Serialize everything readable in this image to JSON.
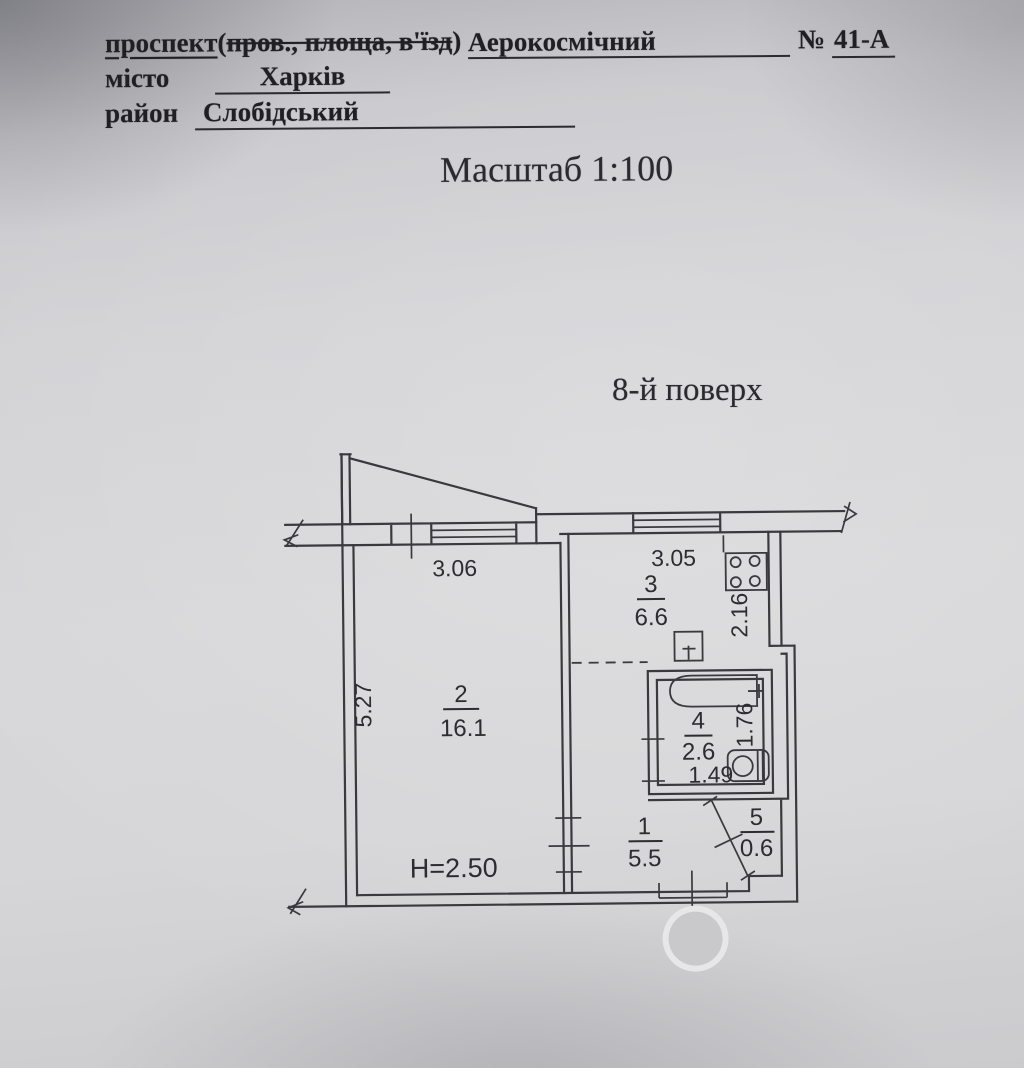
{
  "document": {
    "street": {
      "label_underlined": "проспект",
      "label_paren_open": "(",
      "label_struck": "пров., площа, в'їзд",
      "label_paren_close": ")",
      "value": "Аерокосмічний",
      "number_sign": "№",
      "number_value": "41-А"
    },
    "city": {
      "label": "місто",
      "value": "Харків"
    },
    "district": {
      "label": "район",
      "value": "Слобідський"
    },
    "scale_text": "Масштаб 1:100",
    "floor_text": "8-й поверх"
  },
  "plan": {
    "ceiling_height": "H=2.50",
    "rooms": [
      {
        "number": "1",
        "area": "5.5"
      },
      {
        "number": "2",
        "area": "16.1"
      },
      {
        "number": "3",
        "area": "6.6"
      },
      {
        "number": "4",
        "area": "2.6"
      },
      {
        "number": "5",
        "area": "0.6"
      }
    ],
    "dims": {
      "room2_width": "3.06",
      "room2_depth": "5.27",
      "kitchen_width": "3.05",
      "kitchen_depth": "2.16",
      "bath_width": "1.49",
      "bath_depth": "1.76"
    },
    "fixtures": [
      "stove",
      "sink",
      "bathtub",
      "toilet"
    ],
    "colors": {
      "ink": "#3a3a3e",
      "paper": "#d3d3d6",
      "stamp": "#c9c9cb",
      "stamp_halo": "#e7e7e9"
    }
  }
}
